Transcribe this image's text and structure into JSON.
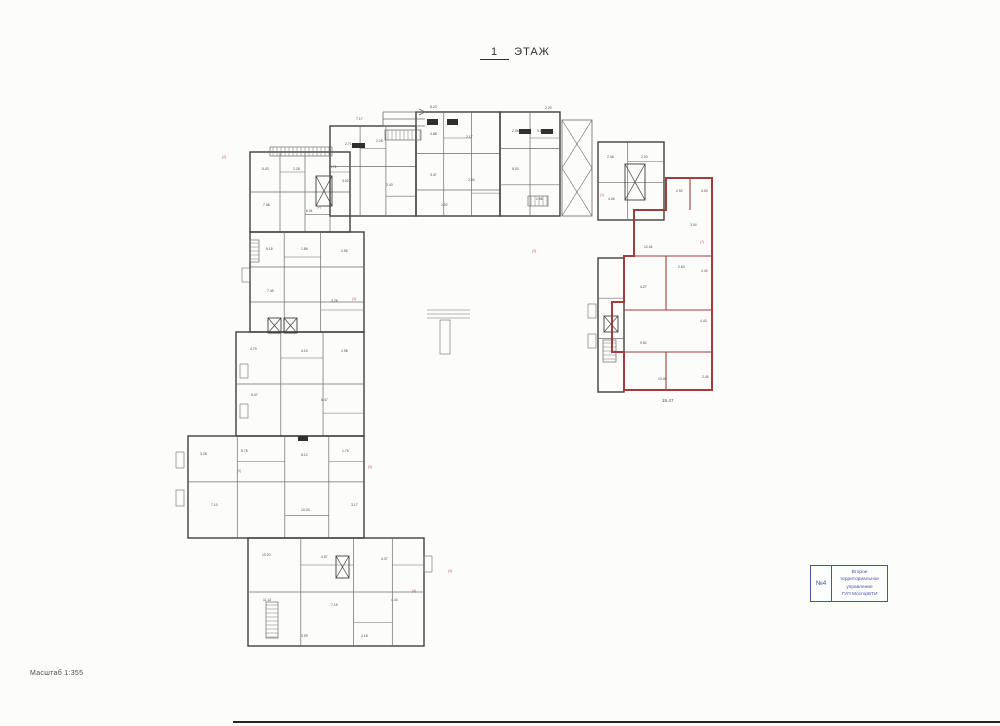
{
  "page": {
    "title_num": "1",
    "title_word": "ЭТАЖ",
    "scale_label": "Масштаб 1:355"
  },
  "stamp": {
    "number": "№4",
    "line1": "Второе территориальное",
    "line2": "управление",
    "line3": "ГУП МосгорБТИ"
  },
  "colors": {
    "wall": "#3f3f3f",
    "line": "#6b6b6b",
    "red": "#a33d3d",
    "red_text": "#c4556a",
    "blue": "#4553a8",
    "label": "#4a4a4a",
    "solid": "#2f2f2f"
  },
  "plan": {
    "blocks": [
      {
        "x": 250,
        "y": 152,
        "w": 100,
        "h": 80,
        "v": [
          0.3,
          0.55,
          0.8
        ],
        "hz": [
          0.5
        ]
      },
      {
        "x": 330,
        "y": 126,
        "w": 86,
        "h": 90,
        "v": [
          0.35,
          0.65
        ],
        "hz": [
          0.45
        ]
      },
      {
        "x": 416,
        "y": 112,
        "w": 84,
        "h": 104,
        "v": [
          0.33,
          0.66
        ],
        "hz": [
          0.4,
          0.75
        ]
      },
      {
        "x": 500,
        "y": 112,
        "w": 60,
        "h": 104,
        "v": [
          0.5
        ],
        "hz": [
          0.35,
          0.7
        ]
      },
      {
        "x": 598,
        "y": 142,
        "w": 66,
        "h": 78,
        "v": [
          0.45
        ],
        "hz": [
          0.52
        ]
      },
      {
        "x": 598,
        "y": 258,
        "w": 26,
        "h": 134,
        "v": [],
        "hz": [
          0.3,
          0.6
        ]
      },
      {
        "x": 250,
        "y": 232,
        "w": 114,
        "h": 100,
        "v": [
          0.3,
          0.62
        ],
        "hz": [
          0.35,
          0.7
        ]
      },
      {
        "x": 236,
        "y": 332,
        "w": 128,
        "h": 104,
        "v": [
          0.35,
          0.68
        ],
        "hz": [
          0.5
        ]
      },
      {
        "x": 188,
        "y": 436,
        "w": 176,
        "h": 102,
        "v": [
          0.28,
          0.55,
          0.8
        ],
        "hz": [
          0.45
        ]
      },
      {
        "x": 248,
        "y": 538,
        "w": 176,
        "h": 108,
        "v": [
          0.3,
          0.6,
          0.82
        ],
        "hz": [
          0.5
        ]
      }
    ],
    "joint": {
      "x": 562,
      "y": 120,
      "w": 30,
      "h": 96
    },
    "elevators": [
      [
        316,
        176,
        16,
        30
      ],
      [
        625,
        164,
        20,
        36
      ],
      [
        268,
        318,
        13,
        15
      ],
      [
        284,
        318,
        13,
        15
      ],
      [
        336,
        556,
        13,
        22
      ],
      [
        604,
        316,
        14,
        16
      ]
    ],
    "stairs": [
      [
        270,
        147,
        62,
        9,
        "h"
      ],
      [
        385,
        130,
        36,
        10,
        "h"
      ],
      [
        266,
        602,
        12,
        36,
        "v"
      ],
      [
        250,
        240,
        9,
        22,
        "v"
      ],
      [
        603,
        340,
        13,
        22,
        "v"
      ],
      [
        528,
        196,
        20,
        10,
        "h"
      ]
    ],
    "solids": [
      [
        427,
        119,
        11,
        6
      ],
      [
        447,
        119,
        11,
        6
      ],
      [
        519,
        129,
        12,
        5
      ],
      [
        541,
        129,
        12,
        5
      ],
      [
        352,
        143,
        13,
        5
      ],
      [
        298,
        436,
        10,
        5
      ]
    ],
    "ramp": {
      "x1": 383,
      "x2": 425,
      "y": 112,
      "lines": 3,
      "gap": 7
    },
    "ticks": [
      [
        176,
        452,
        8,
        16
      ],
      [
        176,
        490,
        8,
        16
      ],
      [
        240,
        364,
        8,
        14
      ],
      [
        240,
        404,
        8,
        14
      ],
      [
        588,
        304,
        8,
        14
      ],
      [
        588,
        334,
        8,
        14
      ],
      [
        424,
        556,
        8,
        16
      ],
      [
        242,
        268,
        8,
        14
      ]
    ],
    "appendix_lines": [
      [
        427,
        310,
        470,
        310
      ],
      [
        427,
        314,
        470,
        314
      ],
      [
        427,
        318,
        470,
        318
      ]
    ],
    "appendix_rect": [
      440,
      320,
      10,
      34
    ],
    "red_outline": "666,178 712,178 712,390 624,390 624,352 612,352 612,302 624,302 624,256 634,256 634,210 666,210",
    "red_lines": [
      [
        666,
        178,
        666,
        210
      ],
      [
        634,
        256,
        712,
        256
      ],
      [
        666,
        256,
        666,
        310
      ],
      [
        624,
        310,
        712,
        310
      ],
      [
        624,
        352,
        712,
        352
      ],
      [
        666,
        352,
        666,
        390
      ],
      [
        690,
        178,
        690,
        210
      ],
      [
        624,
        256,
        634,
        256
      ]
    ],
    "labels": [
      [
        262,
        170,
        "5.43"
      ],
      [
        293,
        170,
        "2.28"
      ],
      [
        330,
        168,
        "3.71"
      ],
      [
        263,
        206,
        "7.08"
      ],
      [
        306,
        212,
        "6.01"
      ],
      [
        345,
        145,
        "2.71"
      ],
      [
        376,
        142,
        "2.28"
      ],
      [
        342,
        182,
        "3.02"
      ],
      [
        386,
        186,
        "2.43"
      ],
      [
        430,
        135,
        "4.88"
      ],
      [
        466,
        138,
        "2.17"
      ],
      [
        430,
        176,
        "3.47"
      ],
      [
        468,
        181,
        "2.84"
      ],
      [
        441,
        206,
        "1.92"
      ],
      [
        512,
        132,
        "2.06"
      ],
      [
        537,
        132,
        "3.17"
      ],
      [
        512,
        170,
        "5.02"
      ],
      [
        536,
        200,
        "2.56"
      ],
      [
        607,
        158,
        "2.46"
      ],
      [
        641,
        158,
        "2.03"
      ],
      [
        608,
        200,
        "4.06"
      ],
      [
        676,
        192,
        "2.92"
      ],
      [
        701,
        192,
        "3.00"
      ],
      [
        690,
        226,
        "3.04"
      ],
      [
        644,
        248,
        "12.44"
      ],
      [
        678,
        268,
        "2.83"
      ],
      [
        701,
        272,
        "2.40"
      ],
      [
        640,
        288,
        "4.27"
      ],
      [
        700,
        322,
        "4.43"
      ],
      [
        640,
        344,
        "9.52"
      ],
      [
        658,
        380,
        "13.40"
      ],
      [
        702,
        378,
        "2.05"
      ],
      [
        266,
        250,
        "6.15"
      ],
      [
        301,
        250,
        "1.86"
      ],
      [
        341,
        252,
        "2.56"
      ],
      [
        267,
        292,
        "7.49"
      ],
      [
        331,
        302,
        "3.28"
      ],
      [
        250,
        350,
        "4.79"
      ],
      [
        301,
        352,
        "3.10"
      ],
      [
        341,
        352,
        "2.98"
      ],
      [
        251,
        396,
        "5.47"
      ],
      [
        321,
        401,
        "6.47"
      ],
      [
        200,
        455,
        "3.28"
      ],
      [
        241,
        452,
        "5.78"
      ],
      [
        301,
        456,
        "8.12"
      ],
      [
        342,
        452,
        "1.76"
      ],
      [
        211,
        506,
        "7.10"
      ],
      [
        301,
        511,
        "10.03"
      ],
      [
        351,
        506,
        "3.17"
      ],
      [
        262,
        556,
        "10.20"
      ],
      [
        321,
        558,
        "4.87"
      ],
      [
        381,
        560,
        "3.37"
      ],
      [
        263,
        601,
        "11.12"
      ],
      [
        331,
        606,
        "7.19"
      ],
      [
        391,
        601,
        "4.43"
      ],
      [
        301,
        637,
        "3.09"
      ],
      [
        361,
        637,
        "3.18"
      ],
      [
        430,
        108,
        "8.23"
      ],
      [
        545,
        109,
        "2.20"
      ],
      [
        356,
        120,
        "7.17"
      ],
      [
        662,
        402,
        "15.47",
        "d"
      ],
      [
        222,
        158,
        "(2)",
        "r"
      ],
      [
        352,
        300,
        "(3)",
        "r"
      ],
      [
        368,
        468,
        "(5)",
        "r"
      ],
      [
        532,
        252,
        "(3)",
        "r"
      ],
      [
        600,
        196,
        "(1)",
        "r"
      ],
      [
        700,
        243,
        "(7)",
        "r"
      ],
      [
        412,
        592,
        "(4)",
        "r"
      ],
      [
        237,
        472,
        "(6)",
        "r"
      ],
      [
        317,
        208,
        "(2)",
        "r"
      ],
      [
        448,
        572,
        "(4)",
        "r"
      ]
    ]
  }
}
